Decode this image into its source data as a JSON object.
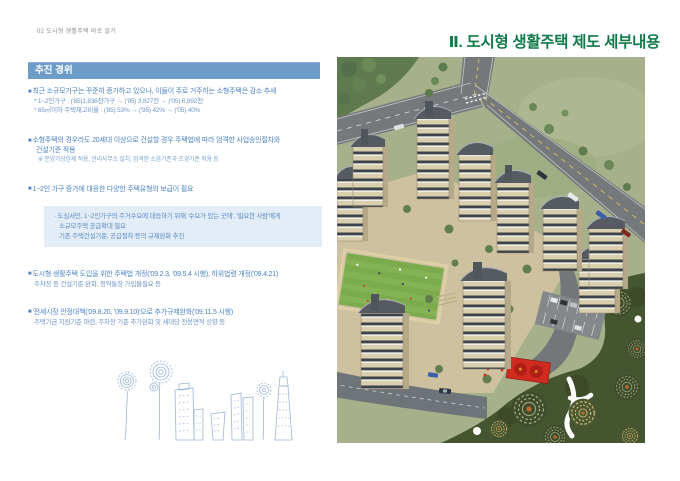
{
  "page": {
    "header_label": "02 도시형 생활주택 바로 알기",
    "title": "Ⅱ. 도시형 생활주택 제도 세부내용"
  },
  "colors": {
    "title_green": "#127a4a",
    "heading_bar_blue": "#6d9cc9",
    "body_text_blue": "#4d83c3",
    "highlight_box_bg": "#e3edf7",
    "sketch_line_blue": "#9db6d8"
  },
  "briefing": {
    "heading": "추진 경위",
    "bullet_char": "■"
  },
  "content": {
    "b1": {
      "text": "최근 소규모가구는 꾸준히 증가하고 있으나, 이들이 주로 거주하는 소형주택은 감소 추세",
      "sub1": "* 1~2인가구 : ('85)1,836천가구 → ('95) 3,827천 → ('05) 6,692천",
      "sub2": "* 65㎡이하 주택재고비율 : ('85) 53% → ('95) 42% → ('05) 40%"
    },
    "b2": {
      "line1": "소형주택의 경우라도 20세대 이상으로 건설할 경우 주택법에 따라 엄격한 사업승인절차와",
      "line2": "건설기준 적용",
      "note": "※ 분양가상한제 적용, 관리사무소 설치, 엄격한 소음기준과 조경기준 적용 등"
    },
    "b3": {
      "text": "1~2인 가구 증가에 대응한 다양한 주택유형의 보급이 필요"
    },
    "box": {
      "line1": "· 도심서민, 1~2인가구의 주거수요에 대응하기 위해 '수요가 있는 곳에', '필요한 사람'에게",
      "line2": "소규모주택 공급확대 필요",
      "line3": "기존 주택건설기준, 공급절차 등의 규제완화 추진"
    },
    "b4": {
      "line1": "도시형 생활주택 도입을 위한 주택법 개정('09.2.3, '09.5.4 시행), 하위법령 개정('09.4.21)",
      "sub": "주차장 등 건설기준 완화, 청약통장 가입불필요 등"
    },
    "b5": {
      "line1": "'전세시장 안정대책('09.8.20, '09.9.10)'으로 추가규제완화('09.11.5 시행)",
      "sub": "주택기금 지원기준 마련, 주차장 기준 추가완화 및 세대당 전용면적 상향 등"
    }
  },
  "illustrations": {
    "photo_icon": "apartment-complex-aerial-rendering",
    "sketch_icon": "hand-drawn-flowers-and-buildings-sketch"
  }
}
